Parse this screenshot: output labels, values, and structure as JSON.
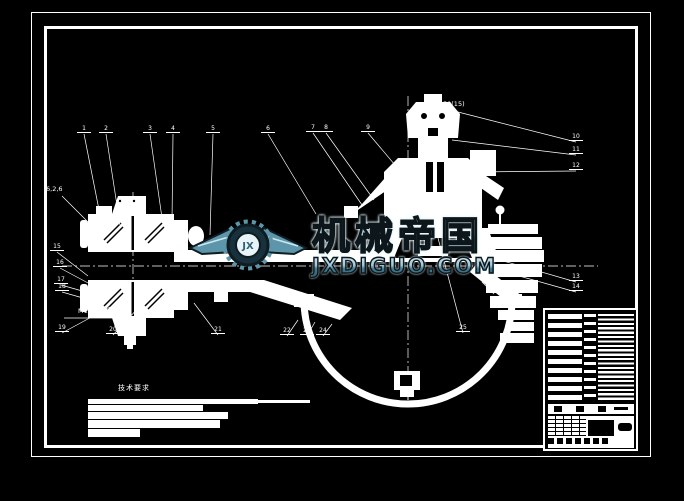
{
  "watermark": {
    "brand": "机械帝国",
    "domain": "JXDIGUO.COM",
    "badge": "JX",
    "accent_color": "#5d96aa"
  },
  "notes": {
    "title": "技术要求"
  },
  "drawing": {
    "dim_labels": [
      {
        "text": "50(15)",
        "x": 443,
        "y": 101,
        "line": [
          440,
          107,
          426,
          107
        ]
      },
      {
        "text": "6,2,6",
        "x": 46,
        "y": 186,
        "line": [
          62,
          196,
          88,
          222
        ]
      },
      {
        "text": "M10×1",
        "x": 78,
        "y": 308,
        "line": [
          64,
          318,
          112,
          318
        ]
      }
    ],
    "callouts": [
      {
        "label": "1",
        "x": 84,
        "y": 133,
        "tx": 103,
        "ty": 230
      },
      {
        "label": "2",
        "x": 106,
        "y": 133,
        "tx": 120,
        "ty": 225
      },
      {
        "label": "3",
        "x": 150,
        "y": 133,
        "tx": 162,
        "ty": 218
      },
      {
        "label": "4",
        "x": 173,
        "y": 133,
        "tx": 172,
        "ty": 222
      },
      {
        "label": "5",
        "x": 213,
        "y": 133,
        "tx": 210,
        "ty": 235
      },
      {
        "label": "6",
        "x": 268,
        "y": 133,
        "tx": 316,
        "ty": 214
      },
      {
        "label": "7",
        "x": 313,
        "y": 132,
        "tx": 362,
        "ty": 205
      },
      {
        "label": "8",
        "x": 326,
        "y": 132,
        "tx": 374,
        "ty": 200
      },
      {
        "label": "9",
        "x": 368,
        "y": 132,
        "tx": 406,
        "ty": 178
      },
      {
        "label": "10",
        "x": 576,
        "y": 141,
        "tx": 458,
        "ty": 112
      },
      {
        "label": "11",
        "x": 576,
        "y": 154,
        "tx": 452,
        "ty": 140
      },
      {
        "label": "12",
        "x": 576,
        "y": 170,
        "tx": 472,
        "ty": 172
      },
      {
        "label": "13",
        "x": 576,
        "y": 281,
        "tx": 500,
        "ty": 260
      },
      {
        "label": "14",
        "x": 576,
        "y": 291,
        "tx": 505,
        "ty": 272
      },
      {
        "label": "15",
        "x": 57,
        "y": 251,
        "tx": 88,
        "ty": 276
      },
      {
        "label": "16",
        "x": 60,
        "y": 267,
        "tx": 90,
        "ty": 284
      },
      {
        "label": "17",
        "x": 61,
        "y": 284,
        "tx": 93,
        "ty": 294
      },
      {
        "label": "18",
        "x": 62,
        "y": 291,
        "tx": 97,
        "ty": 302
      },
      {
        "label": "19",
        "x": 62,
        "y": 332,
        "tx": 110,
        "ty": 307
      },
      {
        "label": "20",
        "x": 113,
        "y": 334,
        "tx": 140,
        "ty": 306
      },
      {
        "label": "21",
        "x": 218,
        "y": 334,
        "tx": 194,
        "ty": 303
      },
      {
        "label": "22",
        "x": 287,
        "y": 335,
        "tx": 298,
        "ty": 320
      },
      {
        "label": "23",
        "x": 307,
        "y": 335,
        "tx": 315,
        "ty": 322
      },
      {
        "label": "24",
        "x": 323,
        "y": 335,
        "tx": 332,
        "ty": 324
      },
      {
        "label": "25",
        "x": 463,
        "y": 332,
        "tx": 428,
        "ty": 200
      },
      {
        "label": "26",
        "x": 494,
        "y": 293,
        "tx": 482,
        "ty": 282
      }
    ]
  }
}
